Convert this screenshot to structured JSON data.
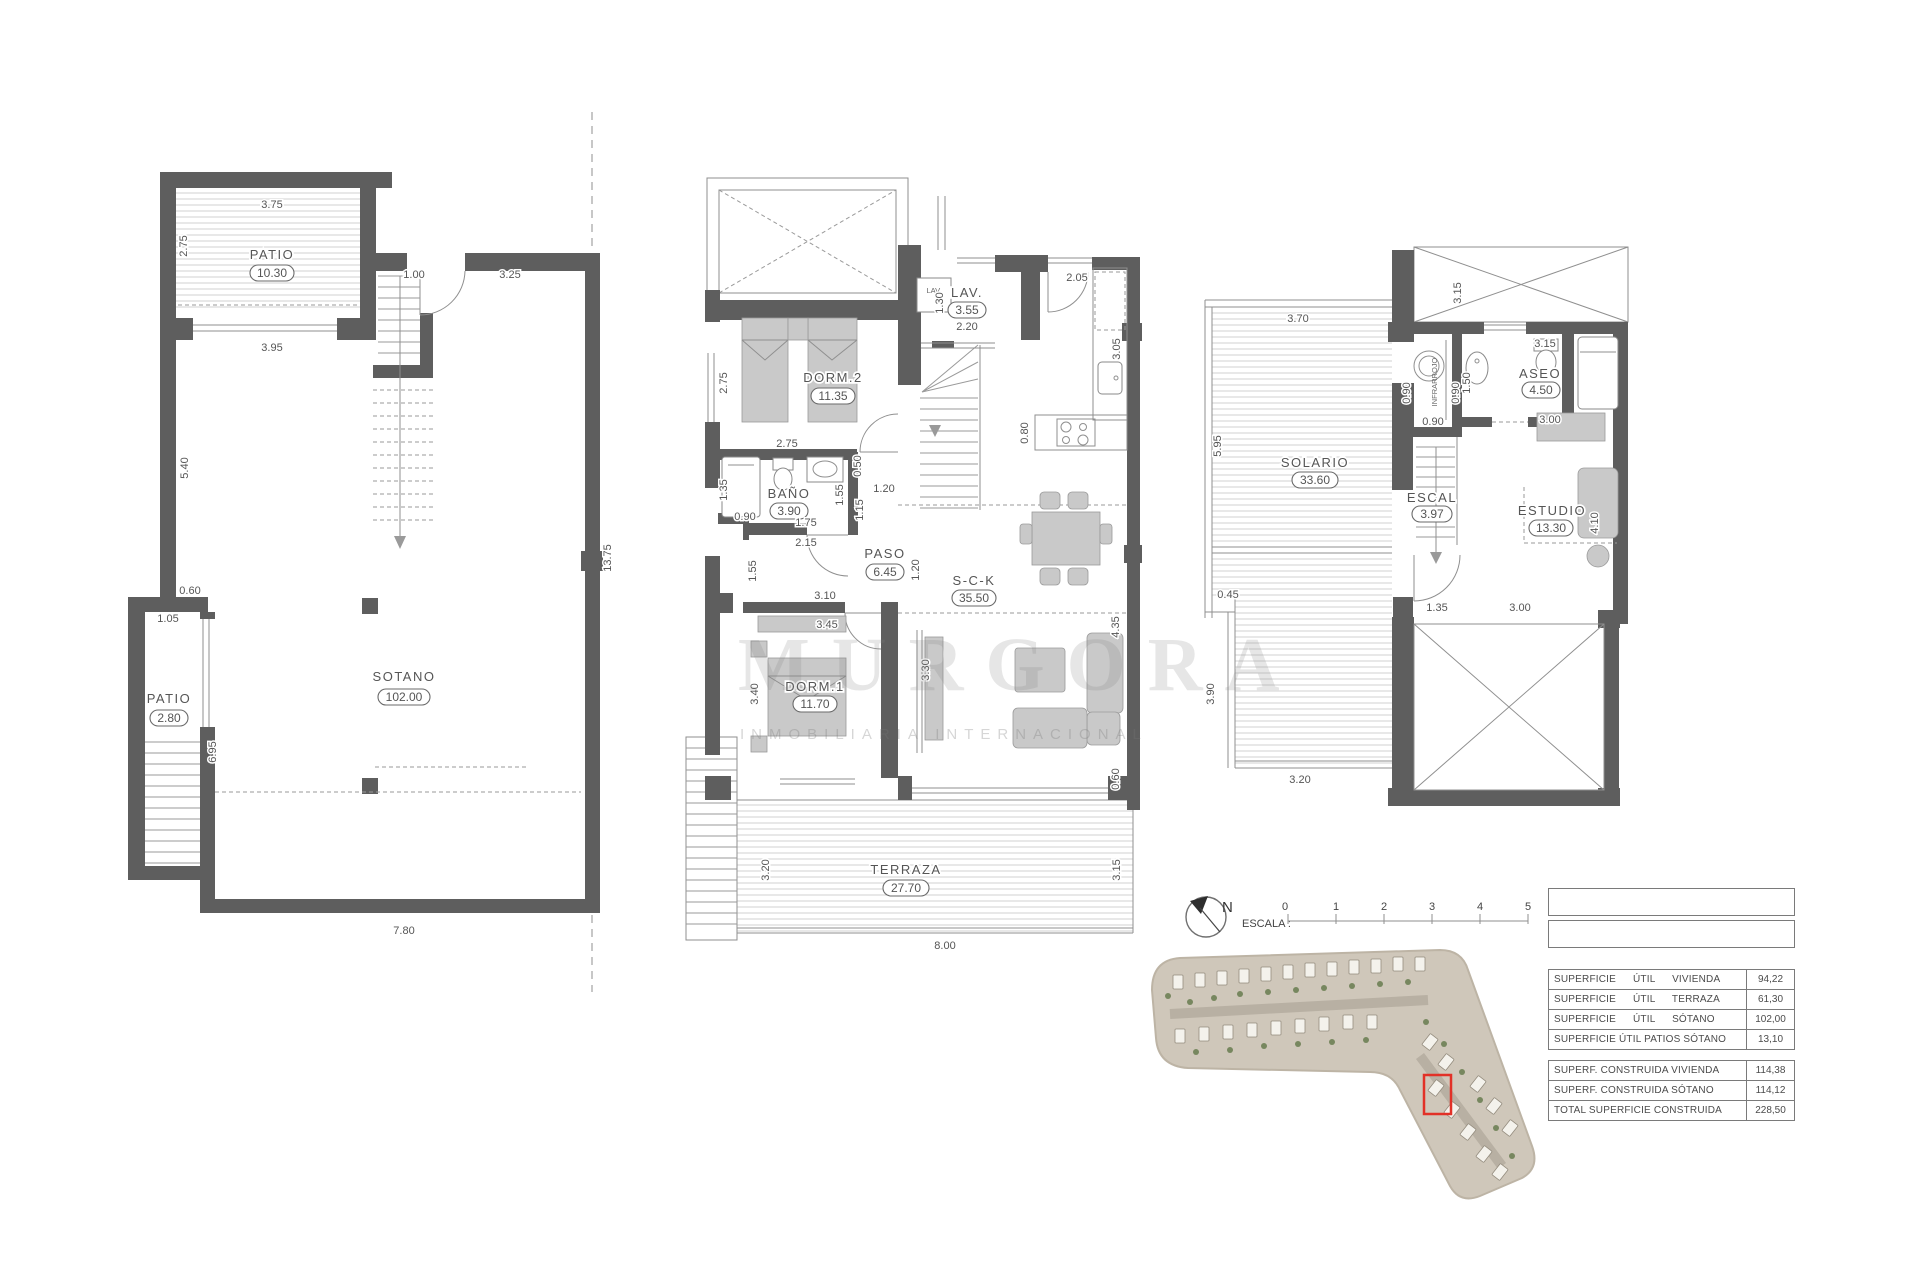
{
  "watermark": {
    "brand": "MURGORA",
    "subtitle": "INMOBILIARIA INTERNACIONAL"
  },
  "sotano": {
    "rooms": {
      "patio1": {
        "name": "PATIO",
        "value": "10.30"
      },
      "sotano": {
        "name": "SOTANO",
        "value": "102.00"
      },
      "patio2": {
        "name": "PATIO",
        "value": "2.80"
      }
    },
    "dims": [
      "3.75",
      "2.75",
      "1.00",
      "3.25",
      "3.95",
      "5.40",
      "13.75",
      "0.60",
      "1.05",
      "6.95",
      "7.80"
    ]
  },
  "baja": {
    "rooms": {
      "dorm2": {
        "name": "DORM.2",
        "value": "11.35"
      },
      "lav": {
        "name": "LAV.",
        "value": "3.55"
      },
      "bano": {
        "name": "BAÑO",
        "value": "3.90"
      },
      "paso": {
        "name": "PASO",
        "value": "6.45"
      },
      "sck": {
        "name": "S-C-K",
        "value": "35.50"
      },
      "dorm1": {
        "name": "DORM.1",
        "value": "11.70"
      },
      "terraza": {
        "name": "TERRAZA",
        "value": "27.70"
      }
    },
    "lav_appliance": "LAV.",
    "dims": [
      "2.75",
      "1.30",
      "2.20",
      "2.05",
      "3.05",
      "0.80",
      "2.75",
      "1.35",
      "0.90",
      "0.50",
      "1.55",
      "1.15",
      "1.20",
      "1.75",
      "2.15",
      "1.55",
      "3.10",
      "3.45",
      "1.20",
      "3.40",
      "3.30",
      "4.35",
      "0.60",
      "3.20",
      "8.00",
      "3.15"
    ]
  },
  "alta": {
    "rooms": {
      "solario": {
        "name": "SOLARIO",
        "value": "33.60"
      },
      "aseo": {
        "name": "ASEO",
        "value": "4.50"
      },
      "escal": {
        "name": "ESCAL",
        "value": "3.97"
      },
      "estudio": {
        "name": "ESTUDIO",
        "value": "13.30"
      }
    },
    "sauna_label": "INFRARROJO",
    "dims": [
      "3.70",
      "5.95",
      "0.45",
      "0.90",
      "0.90",
      "0.90",
      "1.50",
      "3.15",
      "3.15",
      "3.00",
      "4.10",
      "1.35",
      "3.00",
      "3.90",
      "3.20"
    ]
  },
  "meta": {
    "north_label": "N",
    "scale_label": "ESCALA :",
    "scale_ticks": [
      "0",
      "1",
      "2",
      "3",
      "4",
      "5"
    ]
  },
  "tables": {
    "util": {
      "rows": [
        {
          "label": "SUPERFICIE ÚTIL VIVIENDA",
          "value": "94,22"
        },
        {
          "label": "SUPERFICIE ÚTIL TERRAZA",
          "value": "61,30"
        },
        {
          "label": "SUPERFICIE ÚTIL SÓTANO",
          "value": "102,00"
        },
        {
          "label": "SUPERFICIE ÚTIL PATIOS SÓTANO",
          "value": "13,10"
        }
      ]
    },
    "construida": {
      "rows": [
        {
          "label": "SUPERF. CONSTRUIDA VIVIENDA",
          "value": "114,38"
        },
        {
          "label": "SUPERF. CONSTRUIDA SÓTANO",
          "value": "114,12"
        },
        {
          "label": "TOTAL SUPERFICIE CONSTRUIDA",
          "value": "228,50"
        }
      ]
    }
  }
}
